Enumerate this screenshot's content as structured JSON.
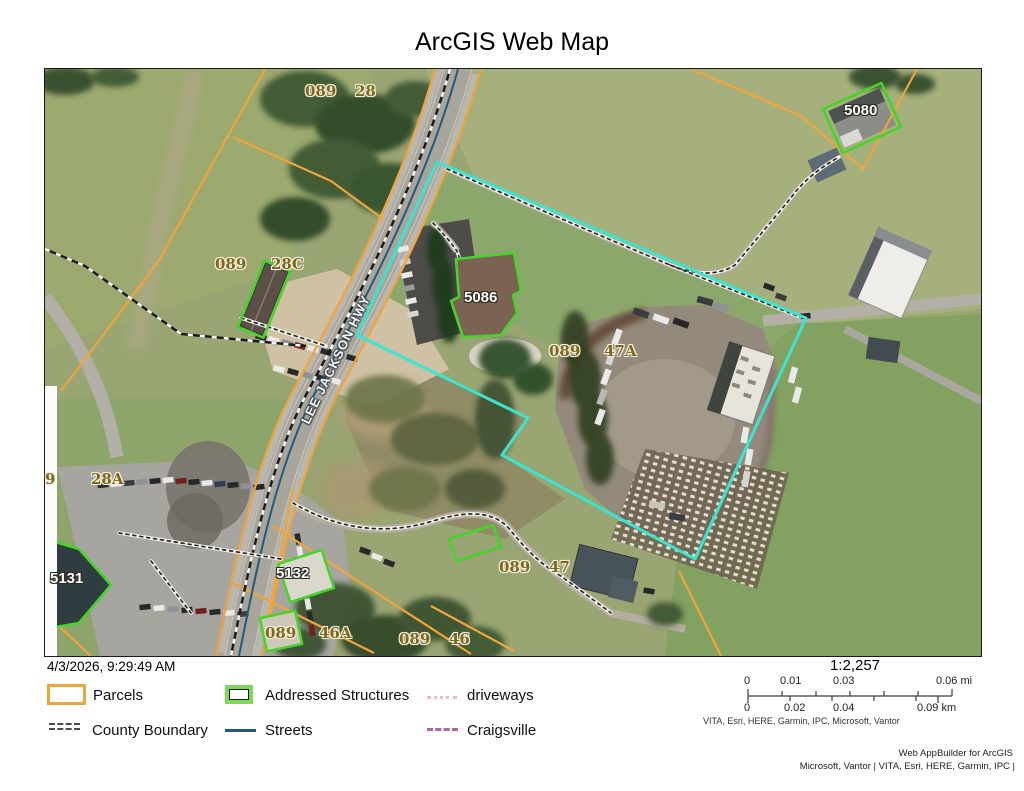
{
  "title": "ArcGIS Web Map",
  "map": {
    "parcel_labels": [
      "089",
      "28",
      "089",
      "28C",
      "089",
      "47A",
      "9",
      "28A",
      "089",
      "47",
      "089",
      "46A",
      "089",
      "46"
    ],
    "structure_labels": [
      "5086",
      "5080",
      "5131",
      "5132"
    ],
    "road_label": "LEE JACKSON HWY",
    "colors": {
      "parcel_line": "#F0A43C",
      "selection_boundary": "#3CE4CF",
      "structure_outline": "#46D32B",
      "street_line": "#235A7C"
    }
  },
  "footer": {
    "timestamp": "4/3/2026, 9:29:49 AM",
    "legend": {
      "items": [
        {
          "label": "Parcels",
          "swatch": "orange-outline-box",
          "color": "#F0A43C"
        },
        {
          "label": "Addressed Structures",
          "swatch": "green-outline-box",
          "color": "#7ED957"
        },
        {
          "label": "driveways",
          "swatch": "pink-dotted-line",
          "color": "#F0B9C6"
        },
        {
          "label": "County Boundary",
          "swatch": "gray-double-dash-line",
          "color": "#4A4A4A"
        },
        {
          "label": "Streets",
          "swatch": "blue-solid-line",
          "color": "#27597A"
        },
        {
          "label": "Craigsville",
          "swatch": "purple-dashed-line",
          "color": "#B065A8"
        }
      ]
    },
    "scale": {
      "ratio": "1:2,257",
      "mi_labels": [
        "0",
        "0.01",
        "0.03",
        "0.06 mi"
      ],
      "km_labels": [
        "0",
        "0.02",
        "0.04",
        "0.09 km"
      ]
    },
    "attribution": "VITA, Esri, HERE, Garmin, IPC, Microsoft, Vantor",
    "credit_line1": "Web AppBuilder for ArcGIS",
    "credit_line2": "Microsoft, Vantor | VITA, Esri, HERE, Garmin, IPC |"
  }
}
